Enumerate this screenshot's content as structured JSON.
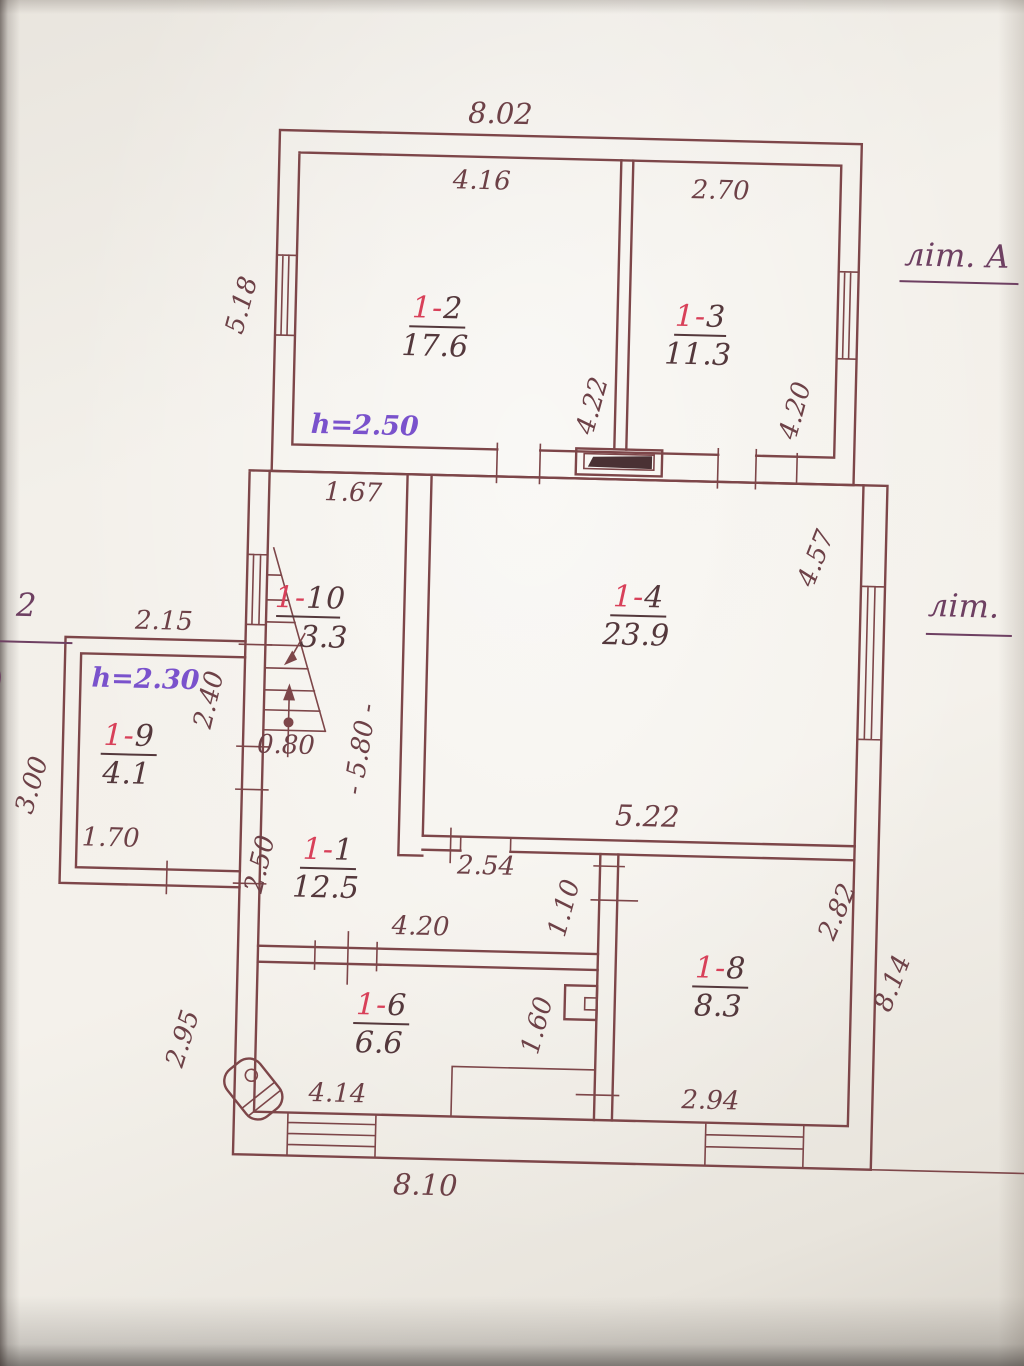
{
  "document": {
    "building_letter": "літ. А",
    "building_letter_partial": "літ.",
    "edge_fragment": "2"
  },
  "rooms": [
    {
      "key": "1-2",
      "prefix": "1-",
      "suffix": "2",
      "area": "17.6"
    },
    {
      "key": "1-3",
      "prefix": "1-",
      "suffix": "3",
      "area": "11.3"
    },
    {
      "key": "1-4",
      "prefix": "1-",
      "suffix": "4",
      "area": "23.9"
    },
    {
      "key": "1-10",
      "prefix": "1-",
      "suffix": "10",
      "area": "3.3"
    },
    {
      "key": "1-9",
      "prefix": "1-",
      "suffix": "9",
      "area": "4.1"
    },
    {
      "key": "1-1",
      "prefix": "1-",
      "suffix": "1",
      "area": "12.5"
    },
    {
      "key": "1-6",
      "prefix": "1-",
      "suffix": "6",
      "area": "6.6"
    },
    {
      "key": "1-8",
      "prefix": "1-",
      "suffix": "8",
      "area": "8.3"
    }
  ],
  "height_notes": [
    {
      "text": "h=2.50"
    },
    {
      "text": "h=2.30"
    }
  ],
  "dimensions": {
    "top_overall": "8.02",
    "room_1_2_width": "4.16",
    "room_1_3_width": "2.70",
    "left_upper": "5.18",
    "room_1_2_depth": "4.22",
    "room_1_3_depth": "4.20",
    "hall_top": "1.67",
    "right_upper": "4.57",
    "annex_width": "2.15",
    "annex_depth": "2.40",
    "annex_side": "3.00",
    "stair_width": "0.80",
    "hall_length": "- 5.80 -",
    "annex_door": "1.70",
    "room_1_4_width": "5.22",
    "right_lower": "8.14",
    "hall_lower": "2.50",
    "passage": "2.54",
    "door_1_8": "1.10",
    "room_1_8_side": "2.82",
    "partition_1_6": "4.20",
    "door_1_6": "1.60",
    "left_lower": "2.95",
    "window_left_bottom": "4.14",
    "window_right_bottom": "2.94",
    "bottom_overall": "8.10"
  },
  "colors": {
    "paper": "#f2efe8",
    "wall_ink": "#7d4649",
    "dim_ink": "#6d4147",
    "room_number_red": "#d84059",
    "area_ink": "#54383c",
    "note_purple": "#7a52cc",
    "letter_ink": "#6e4062"
  }
}
